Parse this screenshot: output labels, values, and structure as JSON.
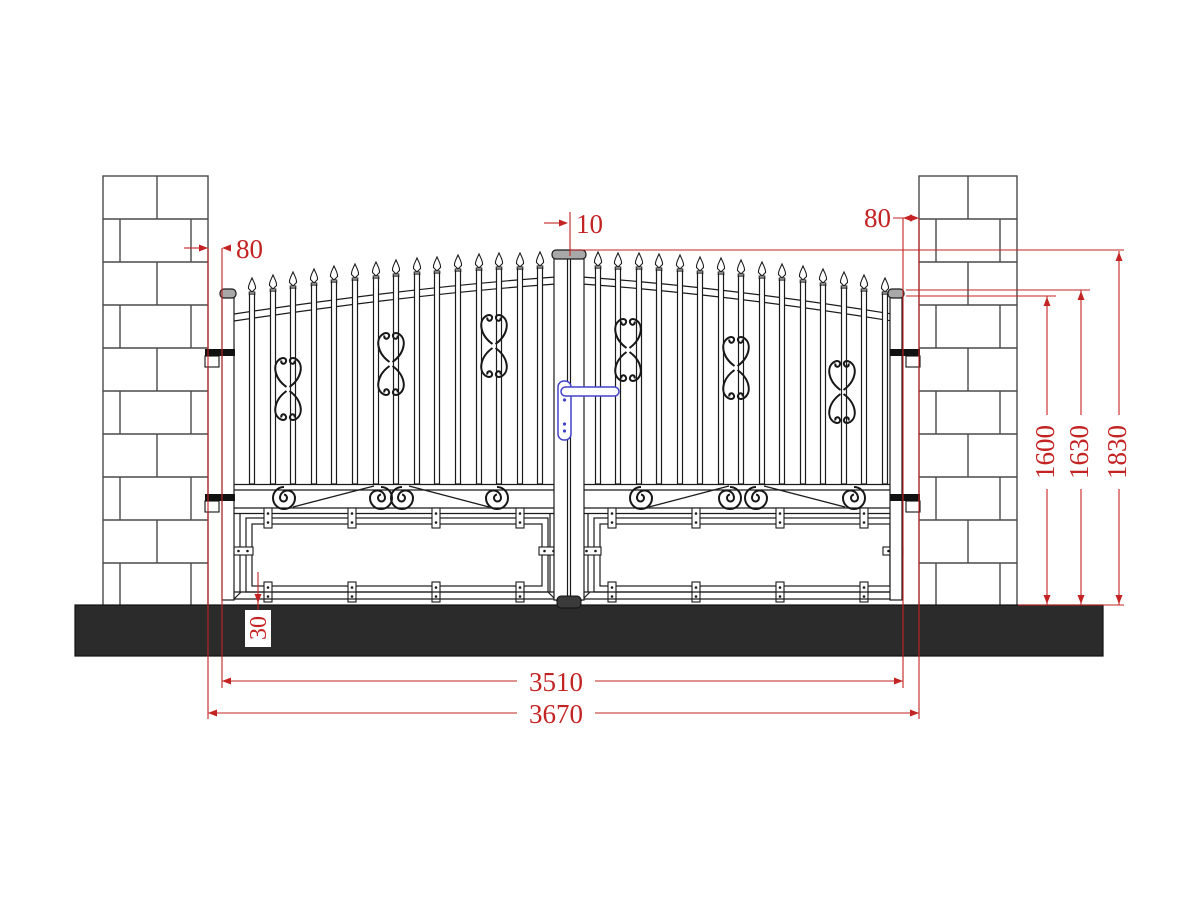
{
  "drawing": {
    "kind": "gate-elevation-technical-drawing"
  },
  "dimensions": {
    "center_gap": "10",
    "left_gap": "80",
    "right_gap": "80",
    "rail_height": "1600",
    "post_height": "1630",
    "total_height": "1830",
    "gate_width": "3510",
    "opening_width": "3670",
    "ground_clearance": "30"
  },
  "colors": {
    "dimension_red": "#c42323",
    "ground_dark": "#2b2b2b",
    "handle_blue": "#4343c8",
    "line_black": "#1a1a1a"
  }
}
